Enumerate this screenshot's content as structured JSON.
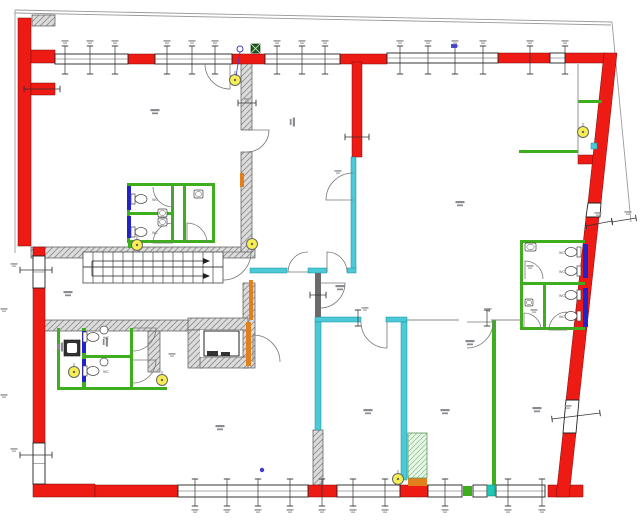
{
  "title": "ground-floor-plan",
  "canvas": {
    "w": 640,
    "h": 520
  },
  "colors": {
    "wall_red": "#ee1a14",
    "wall_red_edge": "#7a0c0c",
    "wall_hatch_bg": "#dcdcdc",
    "wall_hatch_line": "#8f8f8f",
    "wall_cyan": "#4cc9d6",
    "wall_green": "#3fae1e",
    "wall_blue": "#2222cc",
    "wall_orange": "#e2801e",
    "wall_dark": "#6a6a6a",
    "teal_square": "#1ec8b4",
    "light_yellow": "#f7ef52",
    "symbol_blue": "#3b3bd0",
    "tick": "#333333",
    "smudge": "#9a9aa2",
    "property_line": "#9a9a9a",
    "cabinet_bg": "#eaf5ea",
    "cabinet_line": "#7fbf7f"
  },
  "red_walls": [
    [
      18,
      18,
      13,
      228
    ],
    [
      31,
      50,
      24,
      13
    ],
    [
      31,
      83,
      24,
      12
    ],
    [
      128,
      54,
      27,
      10
    ],
    [
      232,
      54,
      33,
      10
    ],
    [
      340,
      54,
      47,
      10
    ],
    [
      498,
      53,
      52,
      10
    ],
    [
      565,
      53,
      41,
      10
    ],
    [
      352,
      62,
      10,
      95
    ],
    [
      578,
      155,
      26,
      9
    ],
    [
      33,
      247,
      12,
      9
    ],
    [
      33,
      288,
      12,
      155
    ],
    [
      33,
      484,
      62,
      13
    ],
    [
      95,
      485,
      83,
      12
    ],
    [
      308,
      485,
      29,
      12
    ],
    [
      400,
      485,
      28,
      12
    ],
    [
      548,
      485,
      35,
      12
    ]
  ],
  "red_polys": [
    [
      [
        604,
        53
      ],
      [
        617,
        53
      ],
      [
        601,
        203
      ],
      [
        588,
        203
      ]
    ],
    [
      [
        586,
        217
      ],
      [
        599,
        217
      ],
      [
        579,
        400
      ],
      [
        566,
        400
      ]
    ],
    [
      [
        563,
        433
      ],
      [
        576,
        433
      ],
      [
        569,
        497
      ],
      [
        556,
        497
      ]
    ]
  ],
  "hatched_walls": [
    [
      32,
      15,
      23,
      11
    ],
    [
      31,
      247,
      224,
      11
    ],
    [
      241,
      62,
      11,
      68
    ],
    [
      241,
      152,
      11,
      100
    ],
    [
      243,
      283,
      12,
      85
    ],
    [
      43,
      320,
      149,
      11
    ],
    [
      148,
      331,
      12,
      41
    ],
    [
      188,
      318,
      60,
      12
    ],
    [
      188,
      330,
      14,
      38
    ],
    [
      200,
      357,
      48,
      11
    ],
    [
      313,
      430,
      10,
      55
    ]
  ],
  "windows": [
    [
      55,
      54,
      73,
      10
    ],
    [
      155,
      54,
      77,
      10
    ],
    [
      265,
      54,
      75,
      10
    ],
    [
      387,
      53,
      111,
      10
    ],
    [
      550,
      53,
      15,
      10
    ],
    [
      33,
      256,
      12,
      32
    ],
    [
      33,
      443,
      12,
      41
    ],
    [
      178,
      485,
      130,
      12
    ],
    [
      337,
      485,
      63,
      12
    ],
    [
      428,
      485,
      34,
      12
    ],
    [
      473,
      485,
      14,
      12
    ],
    [
      496,
      485,
      49,
      12
    ]
  ],
  "window_polys": [
    [
      [
        588,
        203
      ],
      [
        601,
        203
      ],
      [
        600,
        217
      ],
      [
        586,
        217
      ]
    ],
    [
      [
        566,
        400
      ],
      [
        579,
        400
      ],
      [
        576,
        433
      ],
      [
        563,
        433
      ]
    ]
  ],
  "cyan_walls": [
    [
      351,
      157,
      5,
      112
    ],
    [
      250,
      268,
      37,
      5
    ],
    [
      308,
      268,
      19,
      5
    ],
    [
      347,
      268,
      9,
      5
    ],
    [
      315,
      317,
      46,
      5
    ],
    [
      386,
      317,
      21,
      5
    ],
    [
      315,
      322,
      6,
      108
    ],
    [
      401,
      322,
      6,
      158
    ]
  ],
  "green_walls": [
    [
      127,
      183,
      88,
      3
    ],
    [
      127,
      240,
      88,
      3
    ],
    [
      127,
      183,
      3,
      60
    ],
    [
      212,
      183,
      3,
      60
    ],
    [
      171,
      183,
      3,
      60
    ],
    [
      183,
      183,
      3,
      60
    ],
    [
      127,
      212,
      47,
      3
    ],
    [
      57,
      328,
      3,
      62
    ],
    [
      57,
      387,
      110,
      3
    ],
    [
      82,
      328,
      4,
      62
    ],
    [
      130,
      328,
      3,
      62
    ],
    [
      82,
      355,
      51,
      3
    ],
    [
      520,
      240,
      65,
      3
    ],
    [
      520,
      240,
      3,
      90
    ],
    [
      520,
      282,
      65,
      3
    ],
    [
      543,
      285,
      3,
      45
    ],
    [
      520,
      327,
      65,
      3
    ],
    [
      492,
      320,
      4,
      167
    ],
    [
      519,
      150,
      59,
      3
    ],
    [
      578,
      100,
      24,
      3
    ],
    [
      128,
      240,
      8,
      8
    ],
    [
      463,
      486,
      9,
      10
    ]
  ],
  "teal_squares": [
    [
      487,
      485,
      8,
      11
    ]
  ],
  "blue_walls": [
    [
      127,
      186,
      4,
      24
    ],
    [
      127,
      216,
      4,
      22
    ],
    [
      82,
      331,
      4,
      22
    ],
    [
      82,
      359,
      4,
      23
    ],
    [
      583,
      244,
      5,
      34
    ],
    [
      583,
      288,
      5,
      39
    ]
  ],
  "orange_walls": [
    [
      240,
      173,
      4,
      14
    ],
    [
      249,
      280,
      4,
      40
    ],
    [
      246,
      322,
      5,
      44
    ],
    [
      408,
      478,
      19,
      8
    ]
  ],
  "dark_walls": [
    [
      315,
      273,
      6,
      44
    ]
  ],
  "thin_lines": [
    [
      407,
      320,
      459,
      320
    ],
    [
      491,
      320,
      521,
      320
    ],
    [
      578,
      64,
      578,
      156
    ]
  ],
  "property_lines": [
    [
      15,
      10,
      612,
      22
    ],
    [
      15,
      13,
      611,
      25
    ],
    [
      15,
      10,
      15,
      253
    ],
    [
      612,
      22,
      631,
      222
    ]
  ],
  "stairs": {
    "x": 83,
    "y": 252,
    "w": 140,
    "h": 31,
    "steps": 14,
    "mid_y": 267,
    "arrows": [
      [
        92,
        261,
        203,
        261
      ],
      [
        92,
        276,
        203,
        276
      ]
    ],
    "connector": [
      92,
      261,
      92,
      276
    ]
  },
  "elevator": {
    "inner": [
      200,
      330,
      40,
      27
    ],
    "car": [
      204,
      331,
      35,
      25
    ],
    "details": [
      [
        207,
        351,
        11,
        5
      ],
      [
        221,
        352,
        9,
        4
      ]
    ],
    "front_line": [
      204,
      356,
      239,
      356
    ]
  },
  "cabinet": [
    408,
    433,
    19,
    45
  ],
  "doors": [
    [
      230,
      64,
      25,
      90,
      180
    ],
    [
      247,
      130,
      22,
      0,
      90
    ],
    [
      353,
      200,
      27,
      180,
      270
    ],
    [
      308,
      272,
      20,
      180,
      270
    ],
    [
      327,
      272,
      20,
      270,
      360
    ],
    [
      223,
      252,
      28,
      0,
      90
    ],
    [
      253,
      362,
      27,
      270,
      360
    ],
    [
      320,
      283,
      25,
      0,
      90
    ],
    [
      387,
      322,
      26,
      90,
      180
    ],
    [
      467,
      322,
      26,
      0,
      90
    ],
    [
      173,
      187,
      20,
      90,
      180
    ],
    [
      173,
      243,
      20,
      180,
      270
    ],
    [
      187,
      243,
      20,
      270,
      360
    ],
    [
      133,
      328,
      23,
      0,
      90
    ],
    [
      133,
      360,
      23,
      0,
      90
    ],
    [
      525,
      279,
      18,
      270,
      360
    ],
    [
      567,
      330,
      18,
      180,
      270
    ],
    [
      524,
      330,
      17,
      270,
      360
    ]
  ],
  "ticks": [
    [
      65,
      46,
      65,
      74
    ],
    [
      90,
      46,
      90,
      74
    ],
    [
      115,
      46,
      115,
      74
    ],
    [
      167,
      46,
      167,
      74
    ],
    [
      192,
      46,
      192,
      74
    ],
    [
      215,
      46,
      215,
      74
    ],
    [
      277,
      46,
      277,
      74
    ],
    [
      302,
      46,
      302,
      74
    ],
    [
      325,
      46,
      325,
      74
    ],
    [
      400,
      46,
      400,
      74
    ],
    [
      428,
      46,
      428,
      74
    ],
    [
      455,
      46,
      455,
      74
    ],
    [
      483,
      46,
      483,
      74
    ],
    [
      530,
      46,
      530,
      74
    ],
    [
      565,
      46,
      565,
      74
    ],
    [
      195,
      479,
      195,
      506
    ],
    [
      227,
      479,
      227,
      506
    ],
    [
      258,
      479,
      258,
      506
    ],
    [
      290,
      479,
      290,
      506
    ],
    [
      322,
      479,
      322,
      506
    ],
    [
      353,
      479,
      353,
      506
    ],
    [
      385,
      479,
      385,
      506
    ],
    [
      445,
      479,
      445,
      506
    ],
    [
      508,
      479,
      508,
      506
    ],
    [
      542,
      479,
      542,
      506
    ],
    [
      20,
      270,
      52,
      270
    ],
    [
      20,
      455,
      52,
      455
    ],
    [
      24,
      89,
      60,
      89
    ],
    [
      586,
      226,
      612,
      221
    ],
    [
      552,
      419,
      600,
      413
    ],
    [
      612,
      222,
      636,
      218
    ],
    [
      238,
      103,
      256,
      103
    ],
    [
      345,
      137,
      369,
      137
    ],
    [
      310,
      295,
      326,
      295
    ],
    [
      358,
      310,
      358,
      326
    ],
    [
      487,
      310,
      487,
      326
    ]
  ],
  "dim_marks": [
    [
      65,
      42
    ],
    [
      90,
      42
    ],
    [
      115,
      42
    ],
    [
      167,
      42
    ],
    [
      192,
      42
    ],
    [
      215,
      42
    ],
    [
      277,
      42
    ],
    [
      302,
      42
    ],
    [
      325,
      42
    ],
    [
      400,
      42
    ],
    [
      428,
      42
    ],
    [
      455,
      42
    ],
    [
      483,
      42
    ],
    [
      530,
      42
    ],
    [
      565,
      42
    ],
    [
      195,
      511
    ],
    [
      227,
      511
    ],
    [
      258,
      511
    ],
    [
      290,
      511
    ],
    [
      322,
      511
    ],
    [
      353,
      511
    ],
    [
      385,
      511
    ],
    [
      445,
      511
    ],
    [
      508,
      511
    ],
    [
      542,
      511
    ],
    [
      14,
      265
    ],
    [
      14,
      450
    ],
    [
      4,
      310
    ],
    [
      4,
      396
    ],
    [
      598,
      214
    ],
    [
      568,
      407
    ],
    [
      628,
      213
    ],
    [
      338,
      172
    ],
    [
      365,
      309
    ],
    [
      488,
      310
    ],
    [
      172,
      355
    ],
    [
      530,
      267
    ],
    [
      534,
      311
    ],
    [
      247,
      100
    ]
  ],
  "room_marks": [
    [
      155,
      112,
      0
    ],
    [
      292,
      122,
      90
    ],
    [
      460,
      204,
      0
    ],
    [
      68,
      294,
      0
    ],
    [
      220,
      428,
      0
    ],
    [
      368,
      412,
      0
    ],
    [
      445,
      412,
      0
    ],
    [
      537,
      410,
      0
    ],
    [
      470,
      343,
      0
    ],
    [
      340,
      288,
      0
    ],
    [
      60,
      347,
      90
    ],
    [
      105,
      342,
      90
    ]
  ],
  "wc_labels": [
    {
      "x": 152,
      "y": 201,
      "text": "WC"
    },
    {
      "x": 152,
      "y": 234,
      "text": "WC"
    },
    {
      "x": 103,
      "y": 339,
      "text": "WC"
    },
    {
      "x": 103,
      "y": 373,
      "text": "WC"
    },
    {
      "x": 559,
      "y": 254,
      "text": "WC"
    },
    {
      "x": 559,
      "y": 273,
      "text": "WC"
    },
    {
      "x": 559,
      "y": 297,
      "text": "WC"
    },
    {
      "x": 559,
      "y": 318,
      "text": "WC"
    }
  ],
  "lights": [
    [
      235,
      80
    ],
    [
      583,
      132
    ],
    [
      137,
      245
    ],
    [
      252,
      244
    ],
    [
      74,
      372
    ],
    [
      162,
      380
    ],
    [
      398,
      479
    ]
  ],
  "toilets": [
    {
      "x": 141,
      "y": 199,
      "dir": "r"
    },
    {
      "x": 141,
      "y": 232,
      "dir": "r"
    },
    {
      "x": 93,
      "y": 337,
      "dir": "r"
    },
    {
      "x": 93,
      "y": 371,
      "dir": "r"
    },
    {
      "x": 571,
      "y": 252,
      "dir": "l"
    },
    {
      "x": 571,
      "y": 271,
      "dir": "l"
    },
    {
      "x": 571,
      "y": 295,
      "dir": "l"
    },
    {
      "x": 571,
      "y": 316,
      "dir": "l"
    }
  ],
  "sinks_rect": [
    [
      158,
      209,
      9,
      8
    ],
    [
      158,
      218,
      9,
      8
    ],
    [
      525,
      243,
      11,
      8
    ],
    [
      194,
      190,
      9,
      8
    ],
    [
      525,
      299,
      8,
      7
    ]
  ],
  "sinks_round": [
    [
      104,
      330
    ],
    [
      104,
      362
    ]
  ],
  "mop_sink": [
    64,
    340,
    16,
    16
  ],
  "symbols": {
    "blue_stem_circle": {
      "cx": 240,
      "cy": 49,
      "stem": [
        240,
        52,
        236,
        76
      ]
    },
    "blue_glyph": [
      454,
      47
    ],
    "blue_dots": [
      [
        262,
        470
      ]
    ],
    "cyan_square": [
      591,
      143,
      6,
      6
    ],
    "green_x_square": [
      251,
      44,
      9,
      9
    ]
  }
}
